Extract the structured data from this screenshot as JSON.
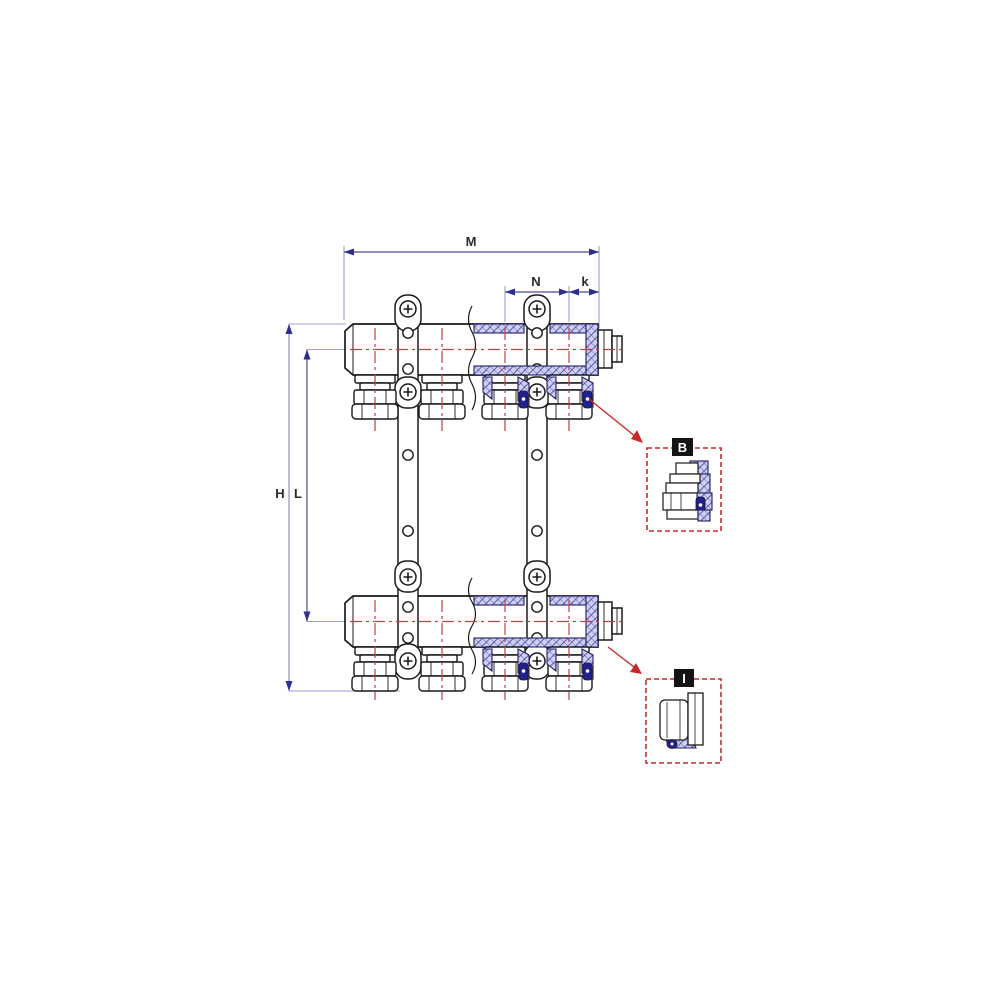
{
  "page": {
    "background": "#ffffff"
  },
  "drawing": {
    "type": "manifold-technical-drawing",
    "dimension_labels": {
      "total_width": "M",
      "outlet_pitch": "N",
      "end_offset": "k",
      "total_height": "H",
      "center_height": "L"
    },
    "detail_callouts": {
      "b_label": "B",
      "i_label": "I"
    },
    "colors": {
      "outline": "#1a1a1a",
      "dimension_line": "#4a4a94",
      "extension_line": "#9f9fd4",
      "centerline_red": "#c04040",
      "detail_red": "#cc2828",
      "hatch_blue": "#3535ac",
      "hatch_fill": "#cfcfef",
      "seal_navy": "#202090"
    }
  }
}
